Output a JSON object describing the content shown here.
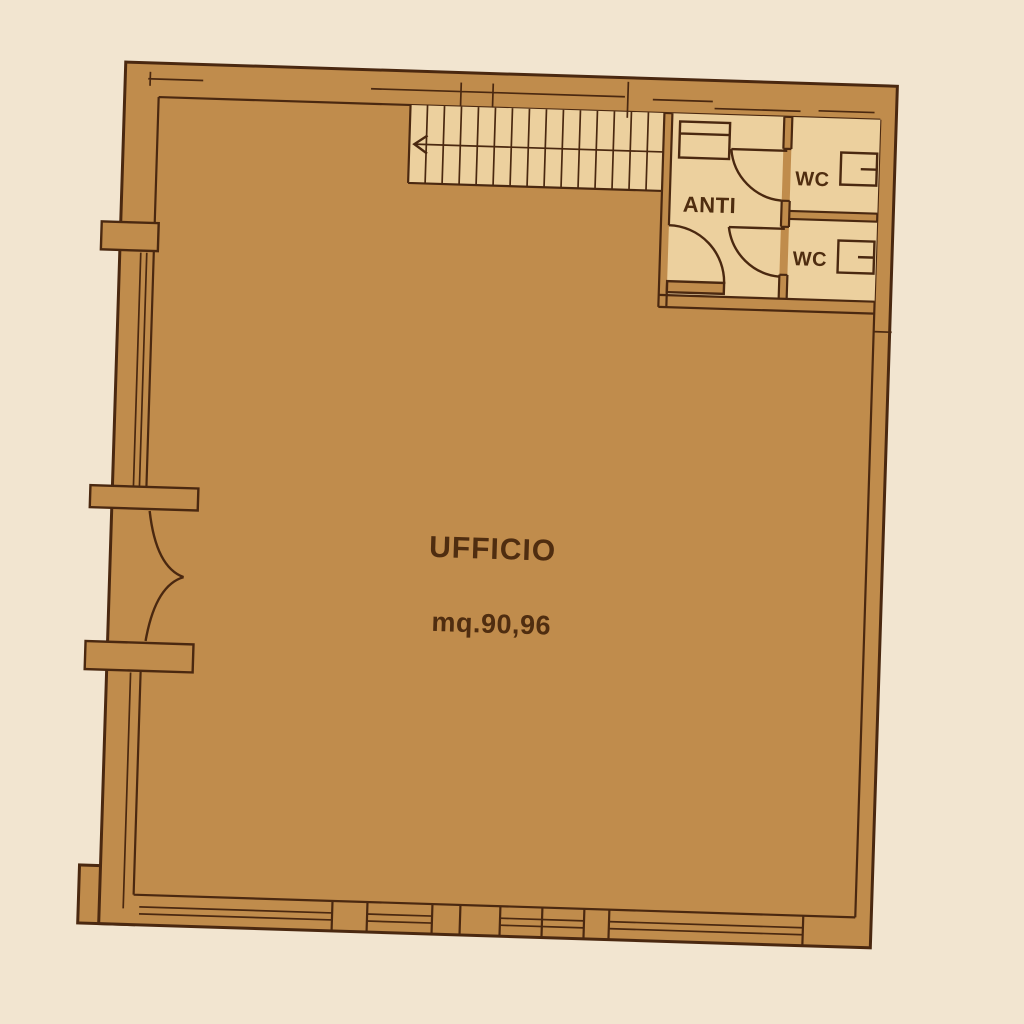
{
  "document": {
    "kind": "floor-plan",
    "description": "scanned sepia office floor plan, slightly rotated"
  },
  "rooms": {
    "office": {
      "name": "UFFICIO",
      "area": "mq.90,96"
    },
    "anteroom": {
      "name": "ANTI"
    },
    "wc_top": {
      "name": "WC"
    },
    "wc_bottom": {
      "name": "WC"
    }
  },
  "stairs": {
    "tread_count": 14,
    "direction_arrow": "left"
  },
  "colors": {
    "background": "#f2e5d0",
    "plan_fill": "#c08c4c",
    "light_floor_fill": "#ecd09e",
    "line": "#4a2810",
    "text": "#4f2d10"
  }
}
